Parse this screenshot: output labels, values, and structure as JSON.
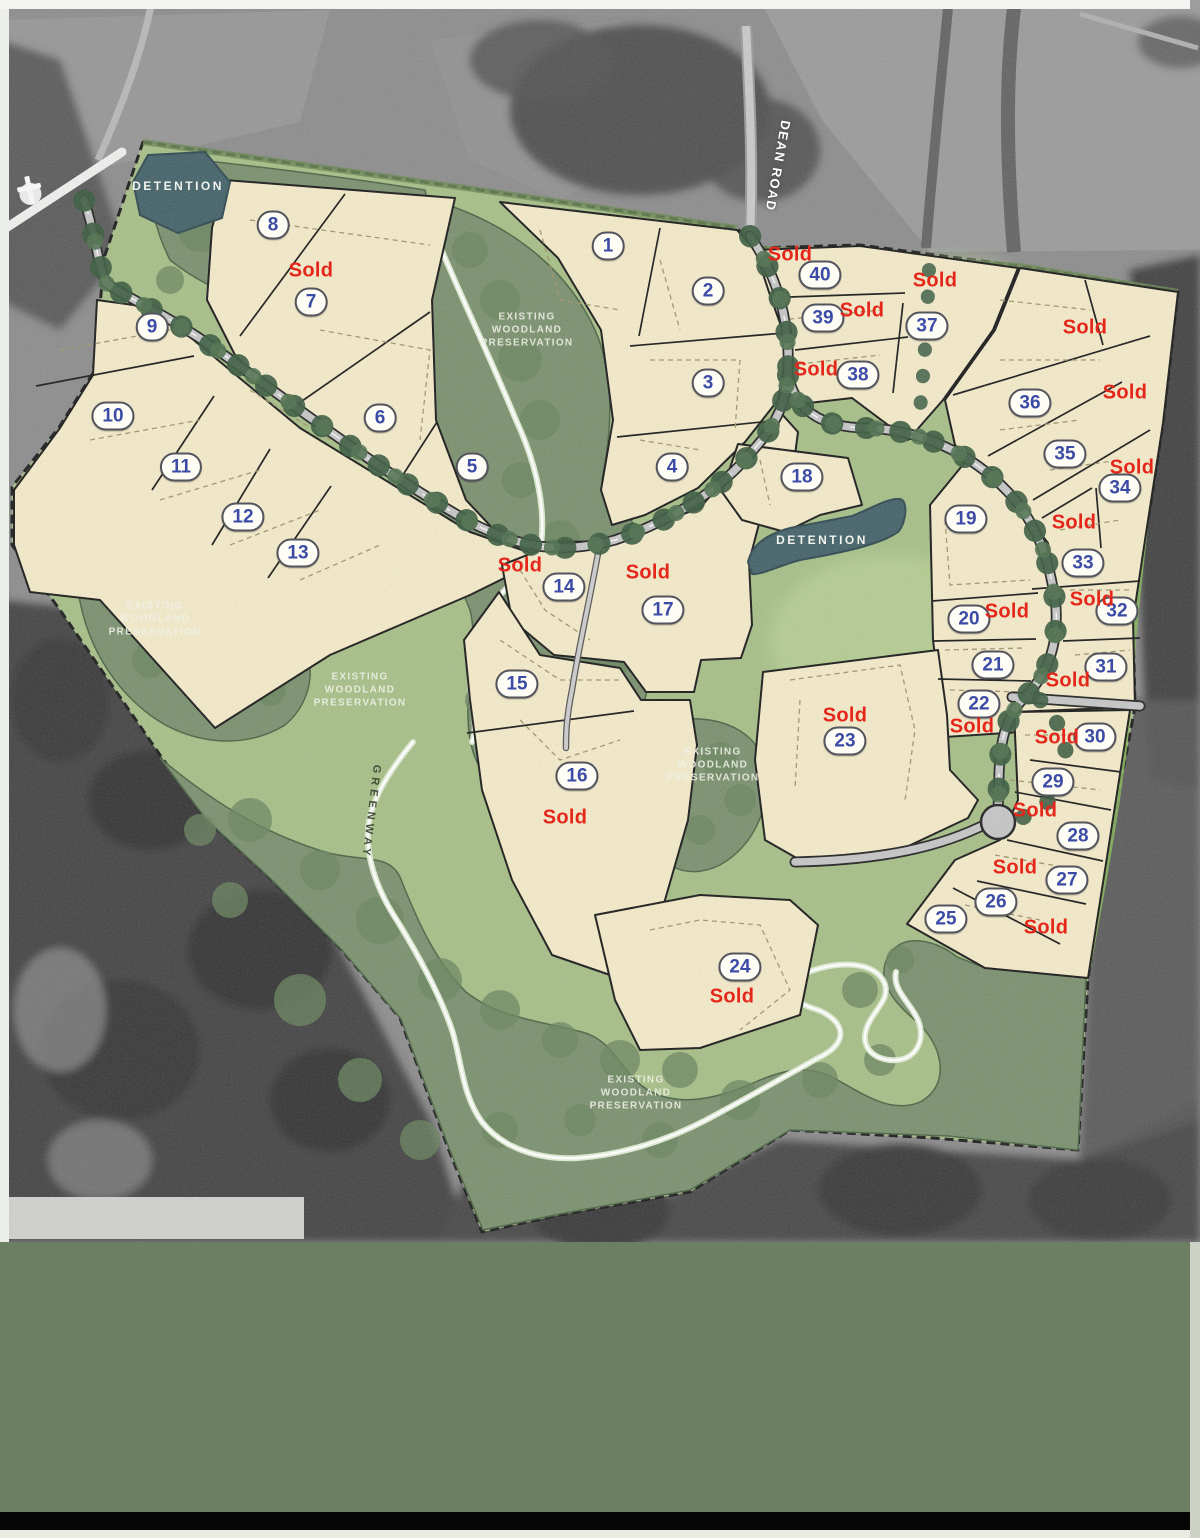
{
  "page": {
    "type": "Residential development lot site plan"
  },
  "map": {
    "sold_text": "Sold",
    "lots": [
      {
        "n": "1",
        "x": 608,
        "y": 246
      },
      {
        "n": "2",
        "x": 708,
        "y": 291
      },
      {
        "n": "3",
        "x": 708,
        "y": 383
      },
      {
        "n": "4",
        "x": 672,
        "y": 467
      },
      {
        "n": "5",
        "x": 472,
        "y": 467
      },
      {
        "n": "6",
        "x": 380,
        "y": 418
      },
      {
        "n": "7",
        "x": 311,
        "y": 302
      },
      {
        "n": "8",
        "x": 273,
        "y": 225
      },
      {
        "n": "9",
        "x": 152,
        "y": 327
      },
      {
        "n": "10",
        "x": 113,
        "y": 416
      },
      {
        "n": "11",
        "x": 181,
        "y": 467
      },
      {
        "n": "12",
        "x": 243,
        "y": 517
      },
      {
        "n": "13",
        "x": 298,
        "y": 553
      },
      {
        "n": "14",
        "x": 564,
        "y": 587
      },
      {
        "n": "15",
        "x": 517,
        "y": 684
      },
      {
        "n": "16",
        "x": 577,
        "y": 776
      },
      {
        "n": "17",
        "x": 663,
        "y": 610
      },
      {
        "n": "18",
        "x": 802,
        "y": 477
      },
      {
        "n": "19",
        "x": 966,
        "y": 519
      },
      {
        "n": "20",
        "x": 969,
        "y": 619
      },
      {
        "n": "21",
        "x": 993,
        "y": 665
      },
      {
        "n": "22",
        "x": 979,
        "y": 704
      },
      {
        "n": "23",
        "x": 845,
        "y": 741
      },
      {
        "n": "24",
        "x": 740,
        "y": 967
      },
      {
        "n": "25",
        "x": 946,
        "y": 919
      },
      {
        "n": "26",
        "x": 996,
        "y": 902
      },
      {
        "n": "27",
        "x": 1067,
        "y": 880
      },
      {
        "n": "28",
        "x": 1078,
        "y": 836
      },
      {
        "n": "29",
        "x": 1053,
        "y": 782
      },
      {
        "n": "30",
        "x": 1095,
        "y": 737
      },
      {
        "n": "31",
        "x": 1106,
        "y": 667
      },
      {
        "n": "32",
        "x": 1117,
        "y": 611
      },
      {
        "n": "33",
        "x": 1083,
        "y": 563
      },
      {
        "n": "34",
        "x": 1120,
        "y": 488
      },
      {
        "n": "35",
        "x": 1065,
        "y": 454
      },
      {
        "n": "36",
        "x": 1030,
        "y": 403
      },
      {
        "n": "37",
        "x": 927,
        "y": 326
      },
      {
        "n": "38",
        "x": 858,
        "y": 375
      },
      {
        "n": "39",
        "x": 823,
        "y": 318
      },
      {
        "n": "40",
        "x": 820,
        "y": 275
      }
    ],
    "sold_labels": [
      {
        "x": 311,
        "y": 271
      },
      {
        "x": 790,
        "y": 255
      },
      {
        "x": 862,
        "y": 311
      },
      {
        "x": 935,
        "y": 281
      },
      {
        "x": 1085,
        "y": 328
      },
      {
        "x": 816,
        "y": 370
      },
      {
        "x": 1125,
        "y": 393
      },
      {
        "x": 1132,
        "y": 468
      },
      {
        "x": 1074,
        "y": 523
      },
      {
        "x": 520,
        "y": 566
      },
      {
        "x": 648,
        "y": 573
      },
      {
        "x": 1092,
        "y": 600
      },
      {
        "x": 1007,
        "y": 612
      },
      {
        "x": 1068,
        "y": 681
      },
      {
        "x": 972,
        "y": 727
      },
      {
        "x": 1057,
        "y": 738
      },
      {
        "x": 845,
        "y": 716
      },
      {
        "x": 565,
        "y": 818
      },
      {
        "x": 1035,
        "y": 811
      },
      {
        "x": 1015,
        "y": 868
      },
      {
        "x": 1046,
        "y": 928
      },
      {
        "x": 732,
        "y": 997
      }
    ],
    "area_labels": [
      {
        "kind": "detention",
        "lines": [
          "DETENTION"
        ],
        "x": 178,
        "y": 186
      },
      {
        "kind": "detention",
        "lines": [
          "DETENTION"
        ],
        "x": 822,
        "y": 540
      },
      {
        "kind": "preserve",
        "lines": [
          "EXISTING",
          "WOODLAND",
          "PRESERVATION"
        ],
        "x": 527,
        "y": 330
      },
      {
        "kind": "preserve",
        "lines": [
          "EXISTING",
          "WOODLAND",
          "PRESERVATION"
        ],
        "x": 155,
        "y": 619
      },
      {
        "kind": "preserve",
        "lines": [
          "EXISTING",
          "WOODLAND",
          "PRESERVATION"
        ],
        "x": 360,
        "y": 690
      },
      {
        "kind": "preserve",
        "lines": [
          "EXISTING",
          "WOODLAND",
          "PRESERVATION"
        ],
        "x": 713,
        "y": 765
      },
      {
        "kind": "preserve",
        "lines": [
          "EXISTING",
          "WOODLAND",
          "PRESERVATION"
        ],
        "x": 636,
        "y": 1093
      }
    ],
    "road_labels": [
      {
        "text": "DEAN ROAD",
        "x": 778,
        "y": 166,
        "rot": 100,
        "kind": "road"
      },
      {
        "text": "GREENWAY",
        "x": 371,
        "y": 812,
        "rot": 97,
        "kind": "trail"
      }
    ],
    "colors": {
      "lot_fill": "#f3eac9",
      "sold_red": "#e5261a",
      "lot_number_blue": "#3c4ca6",
      "site_green": "#a7bf88",
      "woodland_green": "#7c9270",
      "detention_teal": "#46646b",
      "road_gray": "#c6c6c6",
      "footer_band_green": "#6d7f63"
    }
  }
}
